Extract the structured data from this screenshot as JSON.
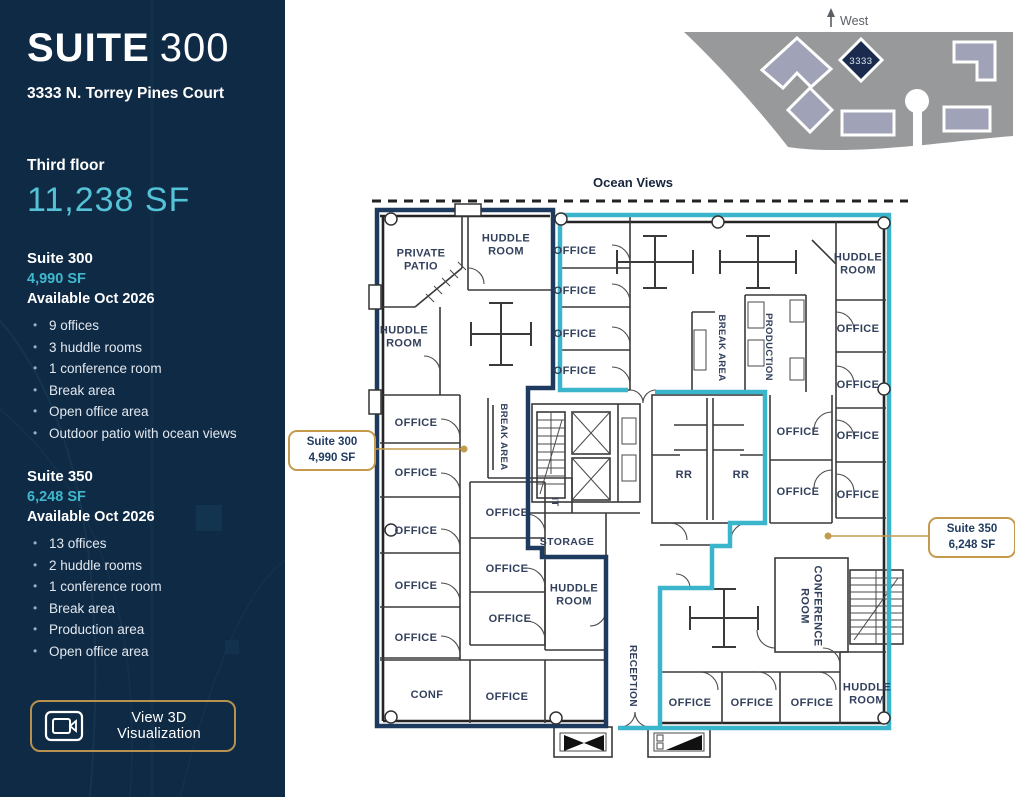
{
  "sidebar": {
    "title_primary": "SUITE",
    "title_secondary": "300",
    "address": "3333 N. Torrey Pines Court",
    "floor_label": "Third floor",
    "floor_area": "11,238 SF",
    "suites": [
      {
        "name": "Suite 300",
        "area": "4,990 SF",
        "availability": "Available Oct 2026",
        "features": [
          "9 offices",
          "3 huddle rooms",
          "1 conference room",
          "Break area",
          "Open office area",
          "Outdoor patio with ocean views"
        ]
      },
      {
        "name": "Suite 350",
        "area": "6,248 SF",
        "availability": "Available Oct 2026",
        "features": [
          "13 offices",
          "2 huddle rooms",
          "1 conference room",
          "Break area",
          "Production area",
          "Open office area"
        ]
      }
    ],
    "cta_label": "View 3D Visualization"
  },
  "sitemap": {
    "direction_label": "West",
    "building_number": "3333"
  },
  "plan": {
    "ocean_label": "Ocean Views",
    "callouts": [
      {
        "title": "Suite 300",
        "area": "4,990 SF"
      },
      {
        "title": "Suite 350",
        "area": "6,248 SF"
      }
    ],
    "colors": {
      "suite300_outline": "#1E3A5F",
      "suite350_outline": "#3BB5CC",
      "callout_gold": "#C49A4D",
      "sidebar_navy": "#0F2A44",
      "teal_accent": "#3FB8CE"
    },
    "labels": [
      {
        "lines": [
          "PRIVATE",
          "PATIO"
        ],
        "x": 421,
        "y": 259
      },
      {
        "lines": [
          "HUDDLE",
          "ROOM"
        ],
        "x": 506,
        "y": 244
      },
      {
        "lines": [
          "HUDDLE",
          "ROOM"
        ],
        "x": 404,
        "y": 336
      },
      {
        "lines": [
          "OFFICE"
        ],
        "x": 416,
        "y": 422
      },
      {
        "lines": [
          "OFFICE"
        ],
        "x": 416,
        "y": 472
      },
      {
        "lines": [
          "OFFICE"
        ],
        "x": 416,
        "y": 530
      },
      {
        "lines": [
          "OFFICE"
        ],
        "x": 416,
        "y": 585
      },
      {
        "lines": [
          "OFFICE"
        ],
        "x": 416,
        "y": 637
      },
      {
        "lines": [
          "CONF"
        ],
        "x": 427,
        "y": 694
      },
      {
        "lines": [
          "OFFICE"
        ],
        "x": 507,
        "y": 696
      },
      {
        "lines": [
          "BREAK AREA"
        ],
        "x": 505,
        "y": 437,
        "rot": 90,
        "size": 9.5
      },
      {
        "lines": [
          "OFFICE"
        ],
        "x": 507,
        "y": 512
      },
      {
        "lines": [
          "OFFICE"
        ],
        "x": 507,
        "y": 568
      },
      {
        "lines": [
          "OFFICE"
        ],
        "x": 510,
        "y": 618
      },
      {
        "lines": [
          "IT"
        ],
        "x": 556,
        "y": 502,
        "rot": 90,
        "size": 9.5
      },
      {
        "lines": [
          "STORAGE"
        ],
        "x": 567,
        "y": 541,
        "size": 10.5
      },
      {
        "lines": [
          "HUDDLE",
          "ROOM"
        ],
        "x": 574,
        "y": 594
      },
      {
        "lines": [
          "OFFICE"
        ],
        "x": 575,
        "y": 250
      },
      {
        "lines": [
          "OFFICE"
        ],
        "x": 575,
        "y": 290
      },
      {
        "lines": [
          "OFFICE"
        ],
        "x": 575,
        "y": 333
      },
      {
        "lines": [
          "OFFICE"
        ],
        "x": 575,
        "y": 370
      },
      {
        "lines": [
          "BREAK AREA"
        ],
        "x": 723,
        "y": 348,
        "rot": 90,
        "size": 9.5
      },
      {
        "lines": [
          "PRODUCTION"
        ],
        "x": 770,
        "y": 347,
        "rot": 90,
        "size": 9.5
      },
      {
        "lines": [
          "RR"
        ],
        "x": 684,
        "y": 474
      },
      {
        "lines": [
          "RR"
        ],
        "x": 741,
        "y": 474
      },
      {
        "lines": [
          "OFFICE"
        ],
        "x": 798,
        "y": 431
      },
      {
        "lines": [
          "OFFICE"
        ],
        "x": 798,
        "y": 491
      },
      {
        "lines": [
          "HUDDLE",
          "ROOM"
        ],
        "x": 858,
        "y": 263
      },
      {
        "lines": [
          "OFFICE"
        ],
        "x": 858,
        "y": 328
      },
      {
        "lines": [
          "OFFICE"
        ],
        "x": 858,
        "y": 384
      },
      {
        "lines": [
          "OFFICE"
        ],
        "x": 858,
        "y": 435
      },
      {
        "lines": [
          "OFFICE"
        ],
        "x": 858,
        "y": 494
      },
      {
        "lines": [
          "CONFERENCE",
          "ROOM"
        ],
        "x": 812,
        "y": 606,
        "rot": 90
      },
      {
        "lines": [
          "RECEPTION"
        ],
        "x": 634,
        "y": 676,
        "rot": 90,
        "size": 10
      },
      {
        "lines": [
          "HUDDLE",
          "ROOM"
        ],
        "x": 867,
        "y": 693
      },
      {
        "lines": [
          "OFFICE"
        ],
        "x": 690,
        "y": 702
      },
      {
        "lines": [
          "OFFICE"
        ],
        "x": 752,
        "y": 702
      },
      {
        "lines": [
          "OFFICE"
        ],
        "x": 812,
        "y": 702
      }
    ]
  }
}
